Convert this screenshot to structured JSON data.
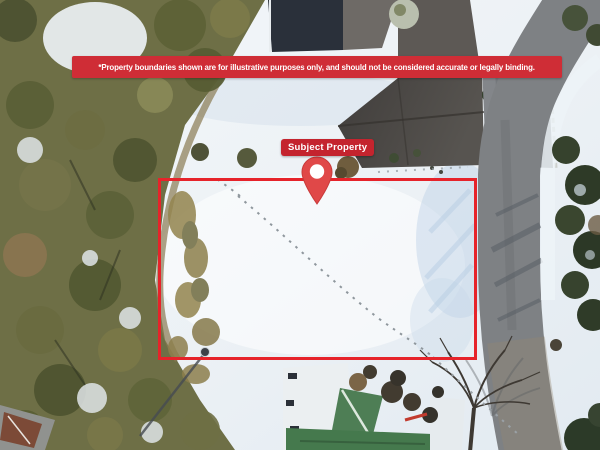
{
  "overlay": {
    "disclaimer_banner": {
      "text": "*Property boundaries shown are for illustrative purposes only, and should not be considered accurate or legally binding.",
      "bg_color": "#cf2d36",
      "text_color": "#ffffff"
    },
    "subject_property_label": {
      "text": "Subject Property",
      "bg_color": "#c4242e",
      "text_color": "#ffffff"
    },
    "boundary": {
      "color": "#e6232a"
    },
    "pin": {
      "color": "#e04848",
      "inner_color": "#ffffff"
    }
  },
  "scene": {
    "type": "aerial-photo",
    "season": "winter-snow",
    "colors": {
      "snow": "#eef2f6",
      "snow_shadow": "#bcd1e6",
      "forest": "#6e6f46",
      "road": "#7e8184",
      "dark_roof": "#4a4742",
      "green_roof": "#45794d",
      "evergreen": "#2e3a27"
    }
  }
}
